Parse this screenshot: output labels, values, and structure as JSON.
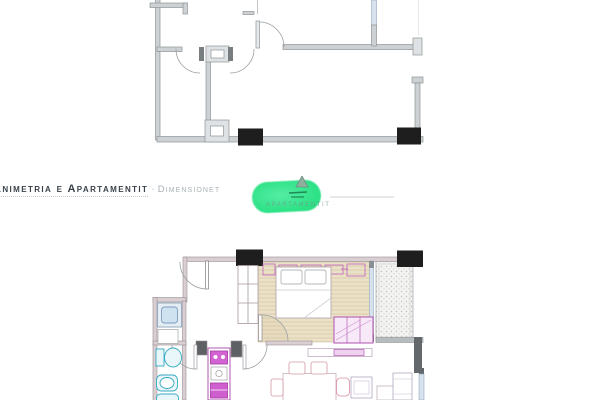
{
  "header": {
    "title": "Animetria e Apartamentit",
    "separator": "·",
    "subtitle": "Dimensionet"
  },
  "logo": {
    "watermark_text": "APARTAMENTIT",
    "pill_color": "#2ee287",
    "pin_icon": "pointer-triangle-icon"
  },
  "plans": {
    "top": {
      "name": "unfurnished-apartment-plan",
      "style": "technical gray linework, two black columns on bottom wall, door swing arcs"
    },
    "bottom": {
      "name": "furnished-apartment-plan",
      "style": "colored plan: bedroom with bed on tan hatched floor, stippled balcony, magenta kitchen unit, teal bathroom fixtures, dining table with chairs, sofa and armchairs"
    }
  },
  "colors": {
    "wall_gray": "#cdd1d3",
    "column_black": "#1e1e1e",
    "window_blue": "#d7e2ec",
    "bedroom_tan": "#ebe1c9",
    "furniture_magenta": "#b457b4",
    "fixture_teal": "#35aac2",
    "accent_green": "#2ee287",
    "title_dark": "#39424a",
    "title_light": "#a9b2b6"
  }
}
